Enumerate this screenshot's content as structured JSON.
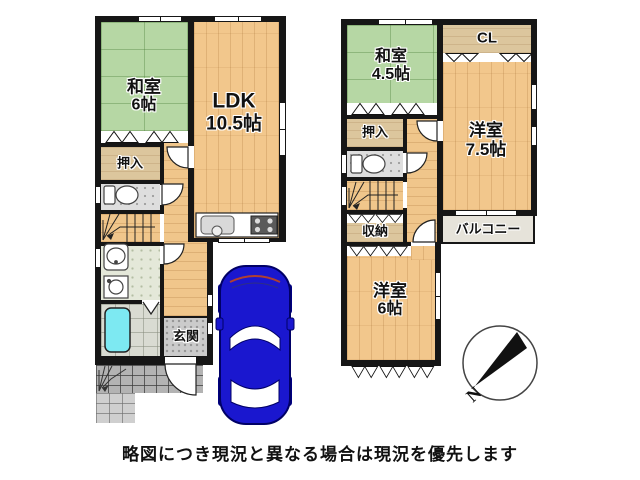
{
  "caption": "略図につき現況と異なる場合は現況を優先します",
  "compass": {
    "north_label": "N"
  },
  "floor1": {
    "rooms": {
      "washitsu": {
        "label": "和室",
        "size": "6帖"
      },
      "ldk": {
        "label": "LDK",
        "size": "10.5帖"
      },
      "oshiire": {
        "label": "押入"
      },
      "genkan": {
        "label": "玄関"
      }
    }
  },
  "floor2": {
    "rooms": {
      "washitsu": {
        "label": "和室",
        "size": "4.5帖"
      },
      "closet": {
        "label": "CL"
      },
      "yoshitsu_large": {
        "label": "洋室",
        "size": "7.5帖"
      },
      "oshiire": {
        "label": "押入"
      },
      "shuno": {
        "label": "収納"
      },
      "balcony": {
        "label": "バルコニー"
      },
      "yoshitsu_small": {
        "label": "洋室",
        "size": "6帖"
      }
    }
  },
  "colors": {
    "wall": "#161616",
    "tatami_green": "#b6d7a4",
    "wood_floor": "#f2c78c",
    "closet_tan": "#dcc69d",
    "bathtub_cyan": "#7de9f2",
    "car_blue": "#1a17cf",
    "balcony_gray": "#e6e3da"
  }
}
